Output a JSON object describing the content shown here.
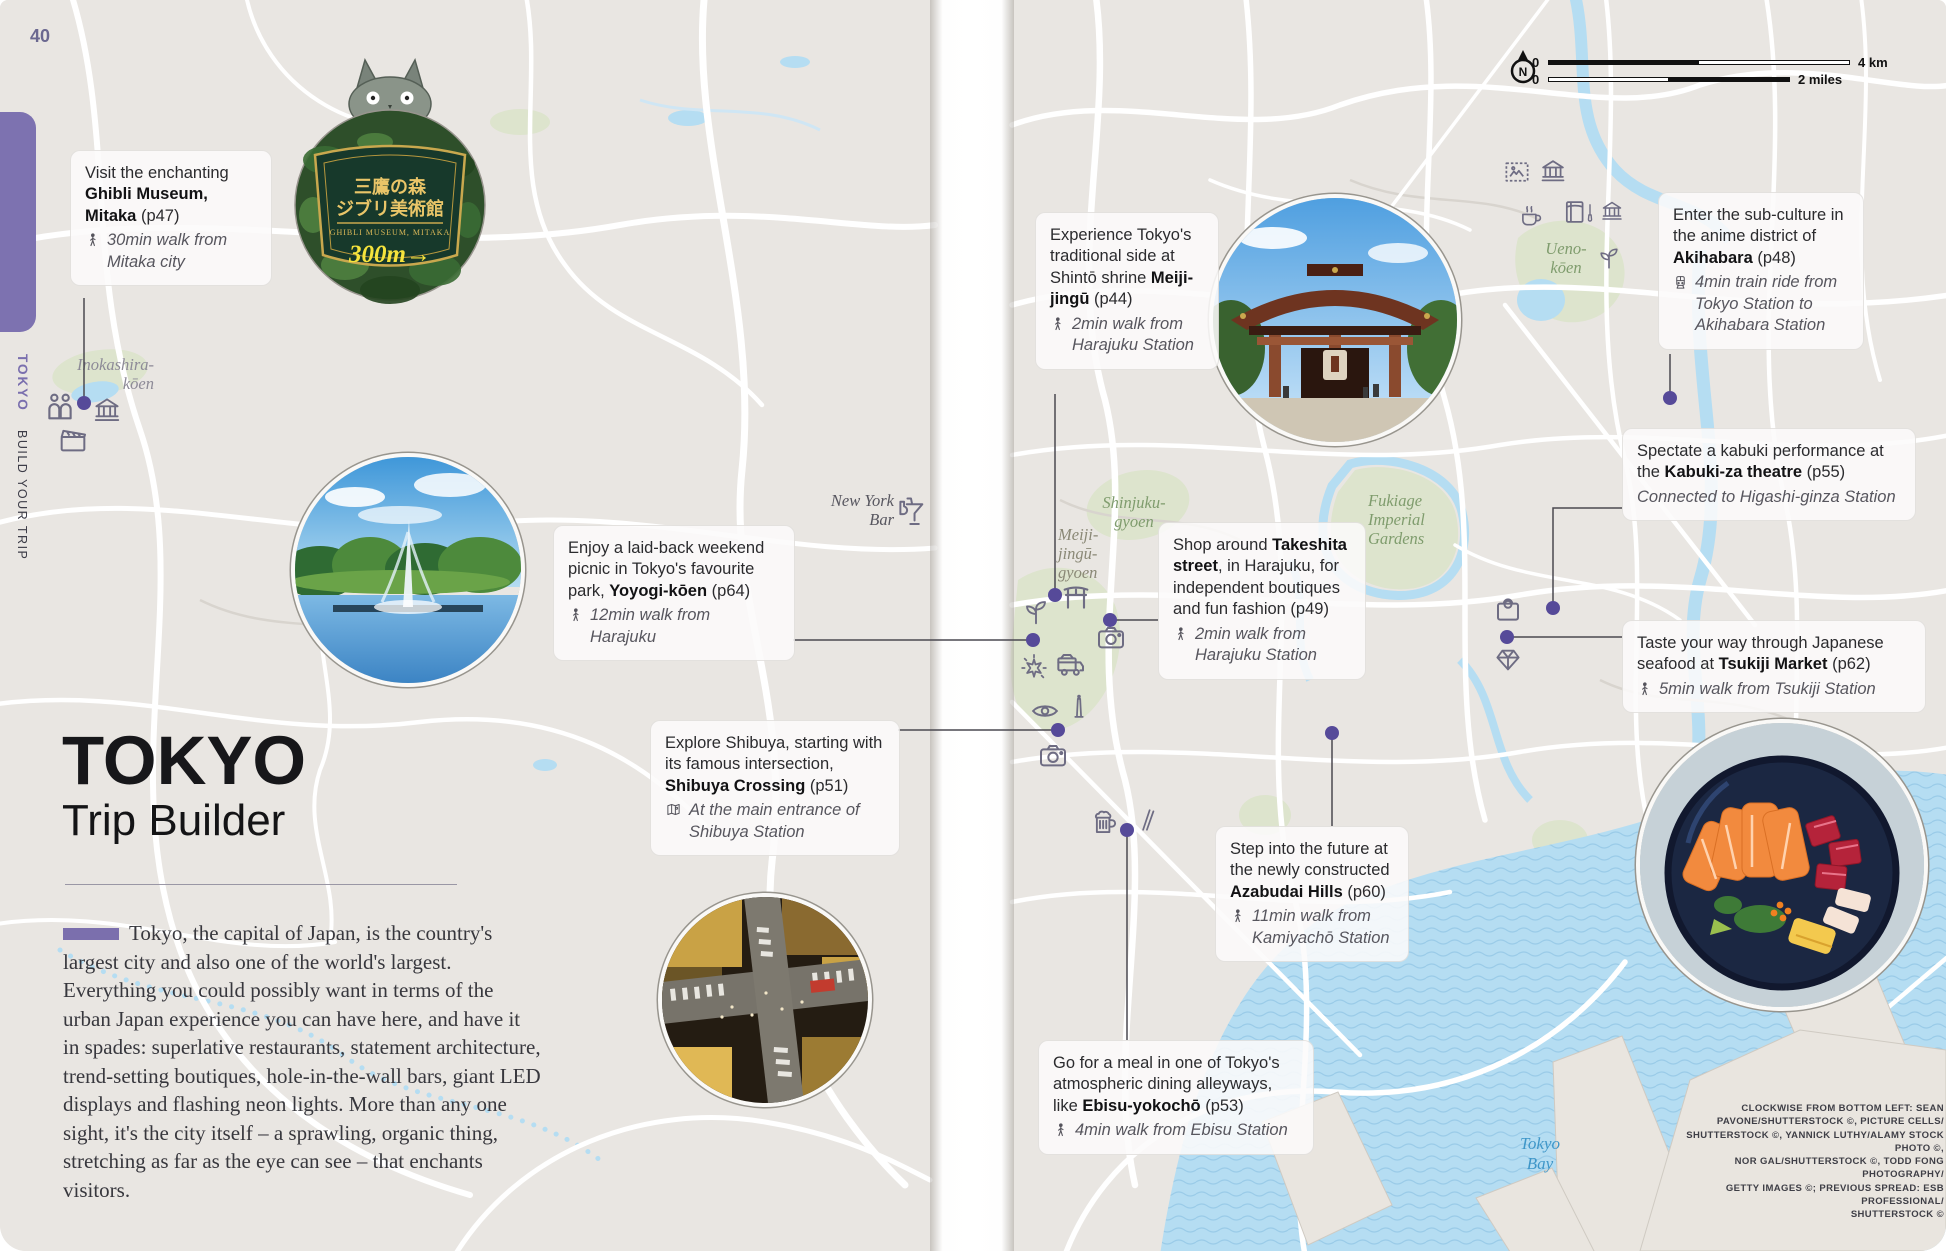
{
  "page": {
    "number": "40"
  },
  "sidebar": {
    "title": "TOKYO",
    "subtitle": "BUILD YOUR TRIP"
  },
  "scalebar": {
    "compass": "N",
    "km_zero": "0",
    "km_label": "4 km",
    "mi_zero": "0",
    "mi_label": "2 miles"
  },
  "title_block": {
    "title": "TOKYO",
    "subtitle": "Trip Builder",
    "intro": "Tokyo, the capital of Japan, is the country's largest city and also one of the world's largest. Everything you could possibly want in terms of the urban Japan experience you can have here, and have it in spades: superlative restaurants, statement architecture, trend-setting boutiques, hole-in-the-wall bars, giant LED displays and flashing neon lights. More than any one sight, it's the city itself – a sprawling, organic thing, stretching as far as the eye can see – that enchants visitors."
  },
  "ghibli_sign": {
    "jp_line1": "三鷹の森",
    "jp_line2": "ジブリ美術館",
    "en_line": "GHIBLI MUSEUM, MITAKA",
    "distance": "300m→"
  },
  "callouts": {
    "ghibli": {
      "pre": "Visit the enchanting ",
      "bold": "Ghibli Museum, Mitaka",
      "post": " (p47)",
      "transit": "30min walk from Mitaka city"
    },
    "yoyogi": {
      "pre": "Enjoy a laid-back weekend picnic in Tokyo's favourite park, ",
      "bold": "Yoyogi-kōen",
      "post": " (p64)",
      "transit": "12min walk from Harajuku"
    },
    "shibuya": {
      "pre": "Explore Shibuya, starting with its famous intersection, ",
      "bold": "Shibuya Crossing",
      "post": " (p51)",
      "transit": "At the main entrance of Shibuya Station"
    },
    "meiji": {
      "pre": "Experience Tokyo's traditional side at Shintō shrine ",
      "bold": "Meiji-jingū",
      "post": " (p44)",
      "transit": "2min walk from Harajuku Station"
    },
    "takeshita": {
      "pre": "Shop around ",
      "bold": "Takeshita street",
      "post": ", in Harajuku, for independent boutiques and fun fashion (p49)",
      "transit": "2min walk from Harajuku Station"
    },
    "akihabara": {
      "pre": "Enter the sub-culture in the anime district of ",
      "bold": "Akihabara",
      "post": " (p48)",
      "transit": "4min train ride from Tokyo Station to Akihabara Station"
    },
    "kabuki": {
      "pre": "Spectate a kabuki performance at the ",
      "bold": "Kabuki-za theatre",
      "post": " (p55)",
      "transit": "Connected to Higashi-ginza Station"
    },
    "tsukiji": {
      "pre": "Taste your way through Japanese seafood at ",
      "bold": "Tsukiji Market",
      "post": " (p62)",
      "transit": "5min walk from Tsukiji Station"
    },
    "azabudai": {
      "pre": "Step into the future at the newly constructed ",
      "bold": "Azabudai Hills",
      "post": " (p60)",
      "transit": "11min walk from Kamiyachō Station"
    },
    "ebisu": {
      "pre": "Go for a meal in one of Tokyo's atmospheric dining alleyways, like ",
      "bold": "Ebisu-yokochō",
      "post": " (p53)",
      "transit": "4min walk from Ebisu Station"
    }
  },
  "map_labels": {
    "inokashira": "Inokashira-\nkōen",
    "new_york_bar": "New York\nBar",
    "shinjuku_gyoen": "Shinjuku-\ngyoen",
    "meiji_jingu_gyoen": "Meiji-\njingū-\ngyoen",
    "ueno_koen": "Ueno-\nkōen",
    "fukiage": "Fukiage\nImperial\nGardens",
    "tokyo_bay": "Tokyo\nBay"
  },
  "credits": "CLOCKWISE FROM BOTTOM LEFT: SEAN\nPAVONE/SHUTTERSTOCK ©, PICTURE CELLS/\nSHUTTERSTOCK ©, YANNICK LUTHY/ALAMY STOCK PHOTO ©,\nNOR GAL/SHUTTERSTOCK ©, TODD FONG PHOTOGRAPHY/\nGETTY IMAGES ©; PREVIOUS SPREAD: ESB PROFESSIONAL/\nSHUTTERSTOCK ©",
  "icon_legend": [
    "walk-icon",
    "train-icon",
    "map-icon",
    "people-icon",
    "museum-icon",
    "clapperboard-icon",
    "torii-icon",
    "sprout-icon",
    "camera-icon",
    "sparkle-icon",
    "food-truck-icon",
    "eye-icon",
    "tower-icon",
    "beer-icon",
    "chopsticks-icon",
    "shopping-bag-icon",
    "gem-icon",
    "stamp-icon",
    "coffee-icon",
    "book-icon",
    "paintbrush-icon",
    "cocktail-icon",
    "compass-icon"
  ],
  "colors": {
    "accent": "#7b6fad",
    "marker": "#574b9b",
    "water": "#b5ddf2",
    "park_label": "#7f9c6d",
    "road": "#ffffff"
  }
}
